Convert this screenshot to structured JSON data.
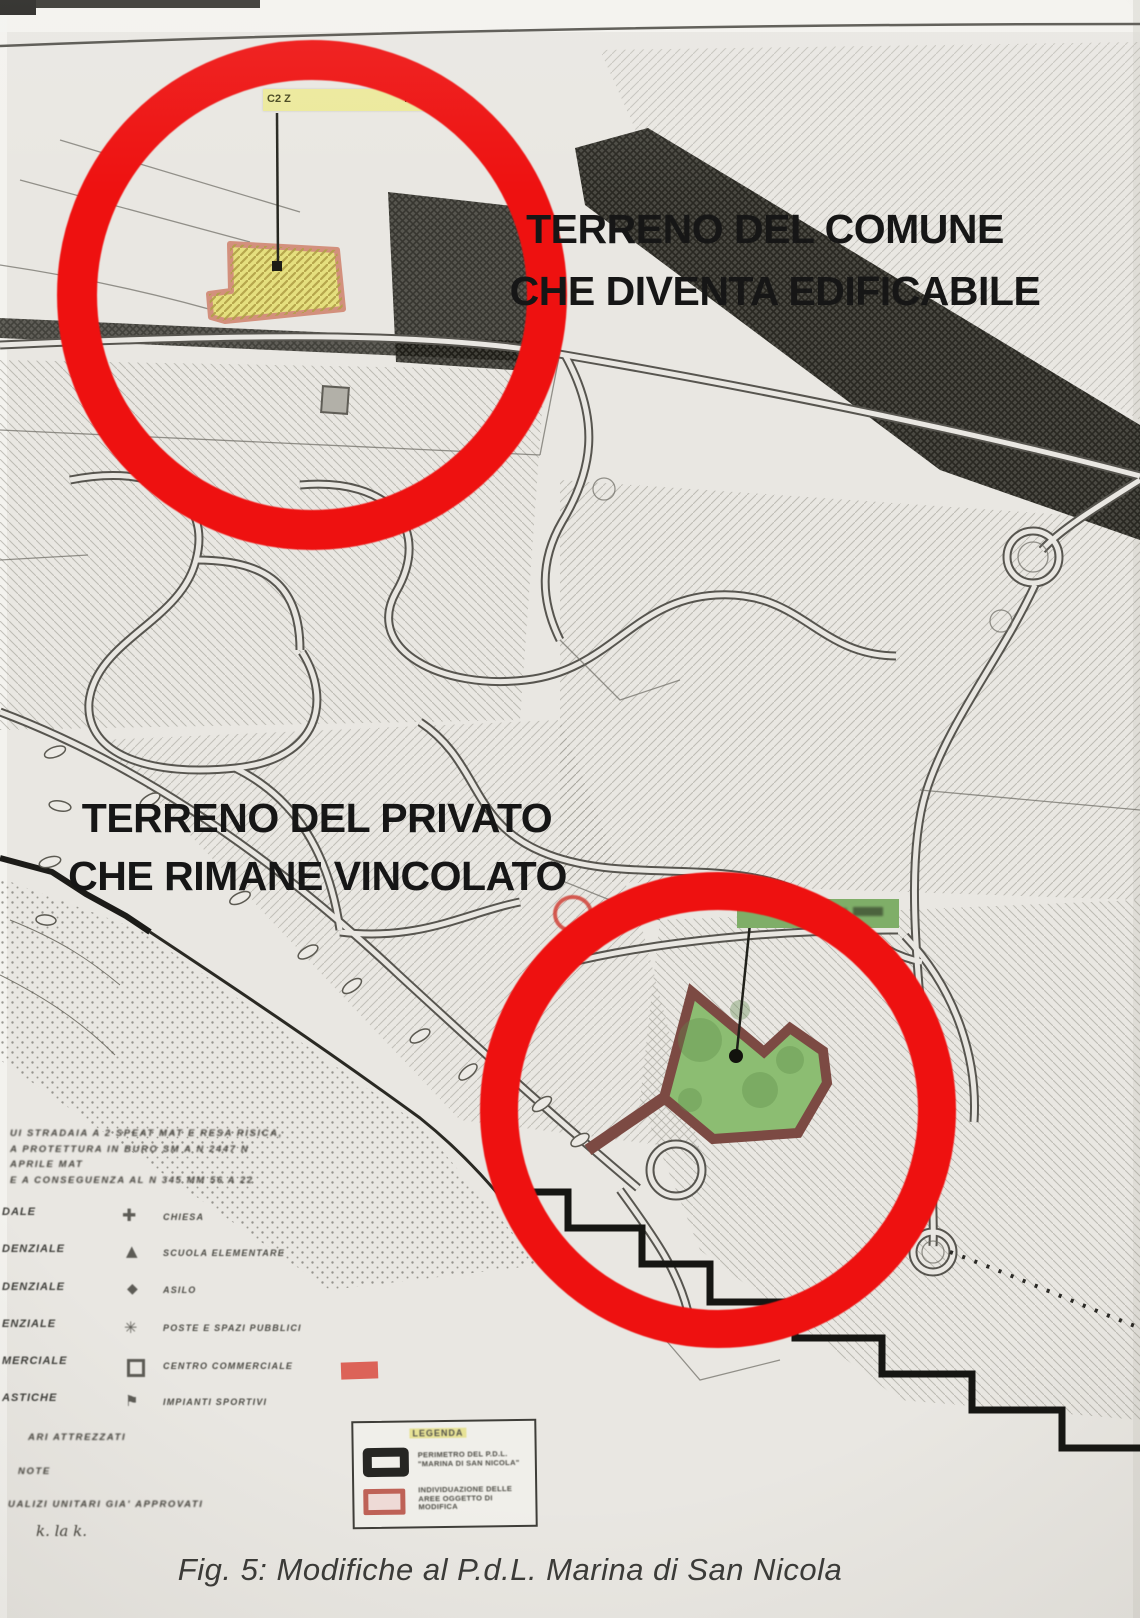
{
  "annotations": {
    "comune_line1": "TERRENO DEL COMUNE",
    "comune_line2": "CHE DIVENTA EDIFICABILE",
    "privato_line1": "TERRENO DEL PRIVATO",
    "privato_line2": "CHE RIMANE VINCOLATO"
  },
  "zone_labels": {
    "yellow_fragment_left": "C2  Z",
    "yellow_fragment_right": "NZIALE"
  },
  "legend_panel": {
    "title": "LEGENDA",
    "item1_label": "PERIMETRO DEL P.D.L. \"MARINA DI SAN NICOLA\"",
    "item2_label": "INDIVIDUAZIONE DELLE AREE OGGETTO DI MODIFICA"
  },
  "mini_legend": {
    "left_fragments": [
      "DALE",
      "DENZIALE",
      "DENZIALE",
      "ENZIALE",
      "MERCIALE",
      "ASTICHE"
    ],
    "rows": [
      {
        "icon": "church-cross-icon",
        "label": "CHIESA"
      },
      {
        "icon": "school-triangle-icon",
        "label": "SCUOLA ELEMENTARE"
      },
      {
        "icon": "kindergarten-diamond-icon",
        "label": "ASILO"
      },
      {
        "icon": "services-starburst-icon",
        "label": "POSTE E SPAZI PUBBLICI"
      },
      {
        "icon": "commercial-square-icon",
        "label": "CENTRO COMMERCIALE"
      },
      {
        "icon": "sports-flag-icon",
        "label": "IMPIANTI SPORTIVI"
      }
    ]
  },
  "illegible_notes": {
    "upper_lines": [
      "UI STRADAIA A 2 SPEAT MAT E RESA RISICA,",
      "A PROTETTURA IN BURO SM A N 2447 N",
      "APRILE MAT",
      "E A CONSEGUENZA AL N 345 MM 56 A 22"
    ],
    "lower_lines": [
      "ARI ATTREZZATI",
      "NOTE",
      "UALIZI UNITARI GIA' APPROVATI"
    ],
    "handwritten": "k. la k."
  },
  "caption": "Fig. 5: Modifiche al P.d.L. Marina di San Nicola",
  "colors": {
    "annotation_red": "#ee1110",
    "parcel_yellow": "#e5df7e",
    "parcel_green": "#8cbd72",
    "parcel_border_salmon": "#d3907d",
    "parcel_border_maroon": "#7c4a43",
    "paper": "#e9e7e2"
  }
}
